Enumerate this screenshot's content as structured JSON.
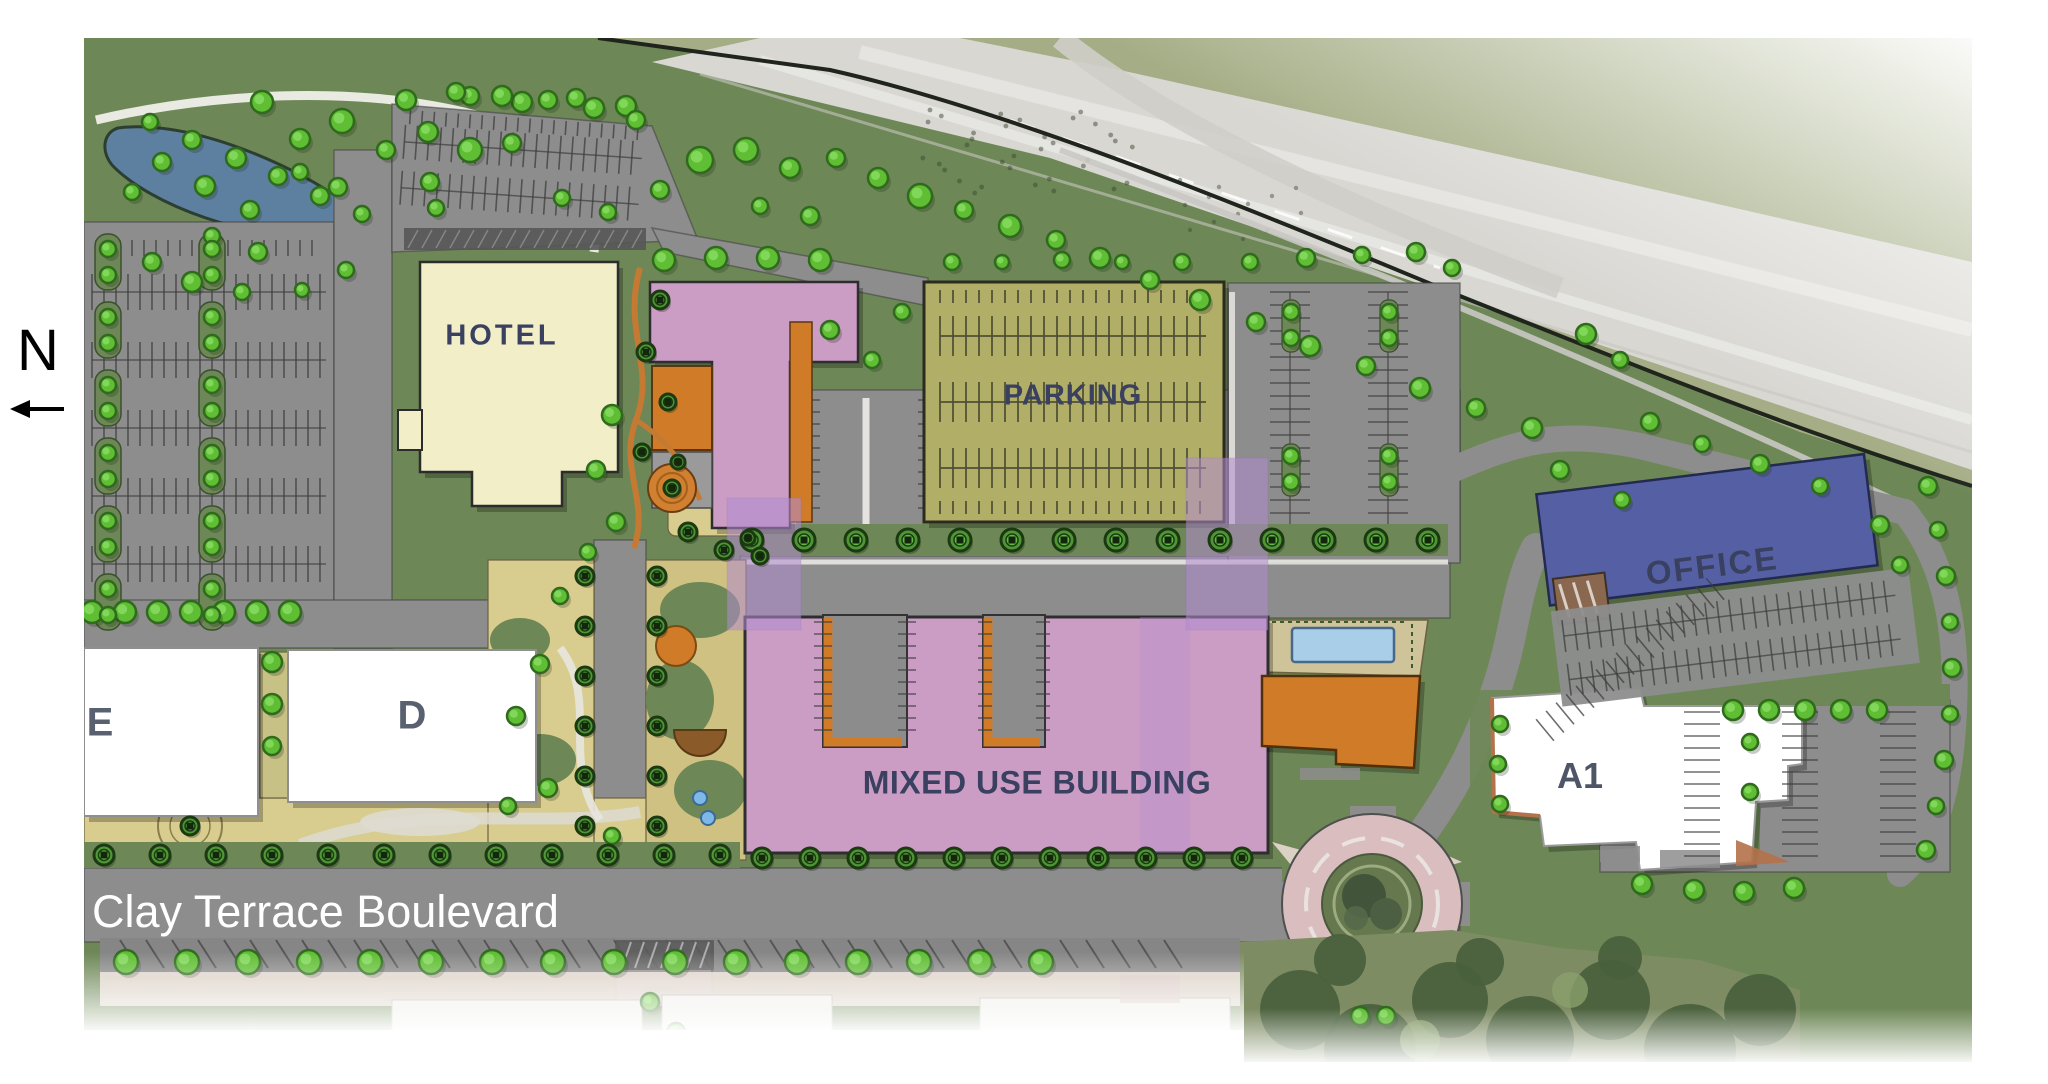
{
  "north_indicator": {
    "label": "N"
  },
  "street": {
    "name": "Clay Terrace Boulevard"
  },
  "labels": {
    "hotel": "HOTEL",
    "parking_garage": "PARKING",
    "office": "OFFICE",
    "mixed_use": "MIXED USE BUILDING",
    "building_e": "E",
    "building_d": "D",
    "building_a1": "A1"
  },
  "colors": {
    "landscape": "#6d8756",
    "aerial_grass": "#a4ad85",
    "highway": "#d8d7d2",
    "road": "#8d8d8d",
    "road_dark": "#7f7f7f",
    "water": "#5d80a0",
    "hotel": "#f1eec8",
    "mixed_use": "#cb9dc5",
    "upper_level_overlay": "#b38cd0",
    "parking_garage": "#b1ae68",
    "office": "#5560a4",
    "amenity_orange": "#d07b28",
    "white_building": "#ffffff",
    "plaza_tan": "#d8cc8e",
    "pool_water": "#a9cfe8",
    "roundabout_paver": "#d9bdbf",
    "tree_bright": "#5fbe33",
    "tree_street": "#4e9636",
    "sidewalk_pink": "#e7d9d2",
    "label_text": "#3a4060",
    "street_text": "#ffffff"
  }
}
